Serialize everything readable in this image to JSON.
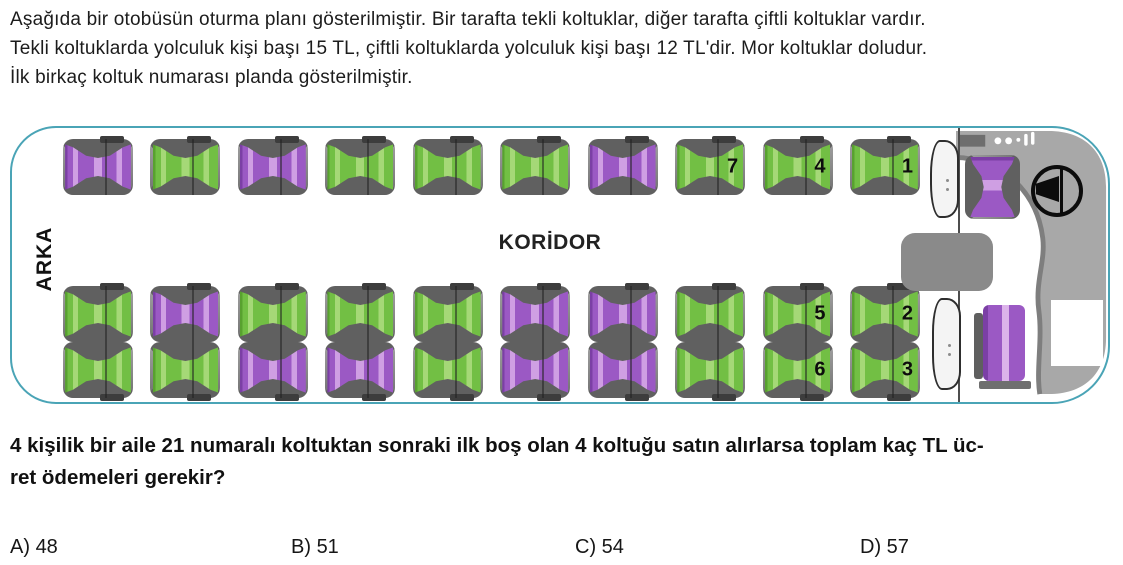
{
  "intro": {
    "lines": [
      "Aşağıda bir otobüsün oturma planı gösterilmiştir. Bir tarafta tekli koltuklar, diğer tarafta çiftli koltuklar vardır.",
      "Tekli koltuklarda yolculuk kişi başı 15 TL, çiftli koltuklarda yolculuk kişi başı 12 TL'dir. Mor koltuklar doludur.",
      "İlk birkaç koltuk numarası planda gösterilmiştir."
    ]
  },
  "bus": {
    "rear_label": "ARKA",
    "corridor_label": "KORİDOR",
    "colors": {
      "outline": "#4aa4b6",
      "empty_dark": "#58a12f",
      "empty_base": "#72bf44",
      "empty_light": "#a5d877",
      "occupied_dark": "#7b3fa5",
      "occupied_base": "#9b59c4",
      "occupied_light": "#cf9fe3"
    },
    "rows": [
      {
        "key": "single-seats",
        "seats": [
          {
            "state": "occupied",
            "label": ""
          },
          {
            "state": "empty",
            "label": ""
          },
          {
            "state": "occupied",
            "label": ""
          },
          {
            "state": "empty",
            "label": ""
          },
          {
            "state": "empty",
            "label": ""
          },
          {
            "state": "empty",
            "label": ""
          },
          {
            "state": "occupied",
            "label": ""
          },
          {
            "state": "empty",
            "label": "7"
          },
          {
            "state": "empty",
            "label": "4"
          },
          {
            "state": "empty",
            "label": "1"
          }
        ]
      },
      {
        "key": "double-seats-aisle",
        "seats": [
          {
            "state": "empty",
            "label": ""
          },
          {
            "state": "occupied",
            "label": ""
          },
          {
            "state": "empty",
            "label": ""
          },
          {
            "state": "empty",
            "label": ""
          },
          {
            "state": "empty",
            "label": ""
          },
          {
            "state": "occupied",
            "label": ""
          },
          {
            "state": "occupied",
            "label": ""
          },
          {
            "state": "empty",
            "label": ""
          },
          {
            "state": "empty",
            "label": "5"
          },
          {
            "state": "empty",
            "label": "2"
          }
        ]
      },
      {
        "key": "double-seats-window",
        "seats": [
          {
            "state": "empty",
            "label": ""
          },
          {
            "state": "empty",
            "label": ""
          },
          {
            "state": "occupied",
            "label": ""
          },
          {
            "state": "occupied",
            "label": ""
          },
          {
            "state": "empty",
            "label": ""
          },
          {
            "state": "occupied",
            "label": ""
          },
          {
            "state": "occupied",
            "label": ""
          },
          {
            "state": "empty",
            "label": ""
          },
          {
            "state": "empty",
            "label": "6"
          },
          {
            "state": "empty",
            "label": "3"
          }
        ]
      }
    ]
  },
  "question": {
    "lines": [
      "4 kişilik bir aile 21 numaralı koltuktan sonraki ilk boş olan 4 koltuğu satın alırlarsa toplam kaç TL üc-",
      "ret ödemeleri gerekir?"
    ]
  },
  "options": [
    {
      "label": "A)",
      "value": "48"
    },
    {
      "label": "B)",
      "value": "51"
    },
    {
      "label": "C)",
      "value": "54"
    },
    {
      "label": "D)",
      "value": "57"
    }
  ]
}
